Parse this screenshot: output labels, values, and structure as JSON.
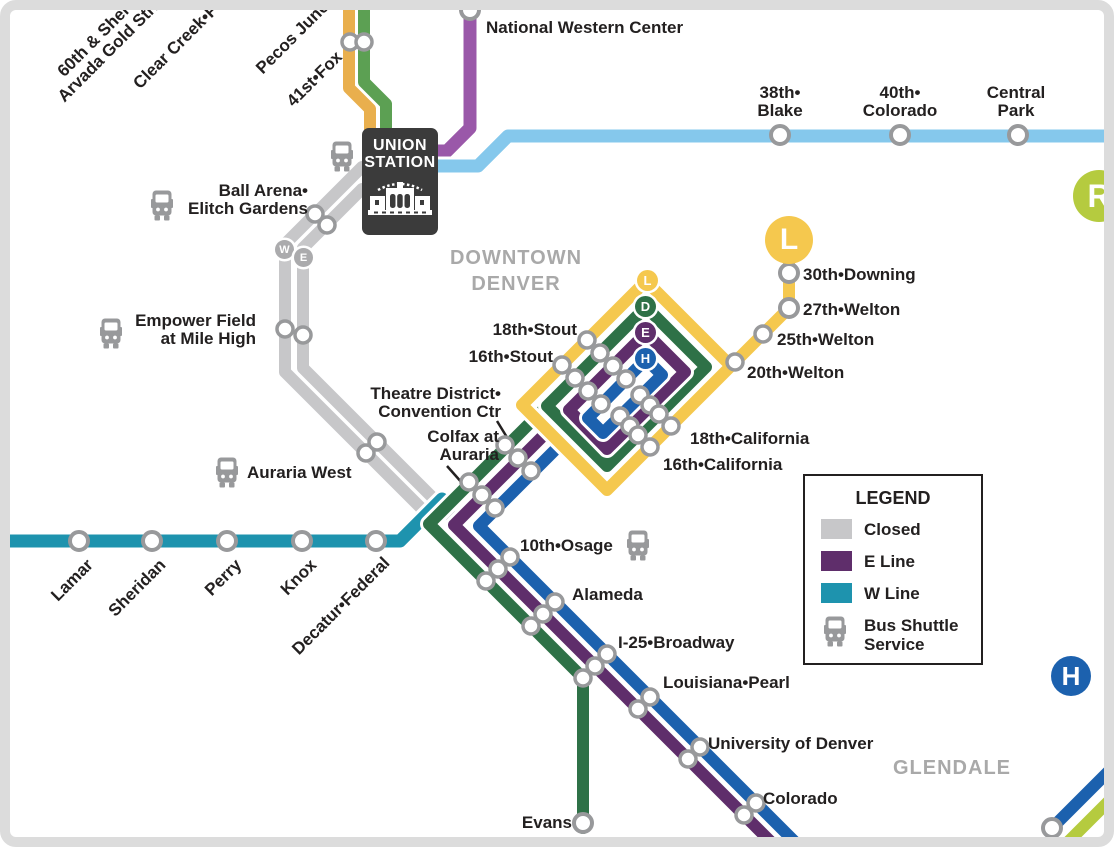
{
  "colors": {
    "l_line_yellow": "#f5c84e",
    "g_line_gold": "#e9af4d",
    "b_line_green": "#5ca053",
    "d_line_green": "#2e7147",
    "e_line_purple": "#5f2e6b",
    "n_line_purple": "#9a58a9",
    "h_line_blue": "#1c61ae",
    "a_line_blue": "#85c8ec",
    "w_line_teal": "#1e93ae",
    "r_line_lime": "#b5cb3f",
    "closed_gray": "#c7c7c9",
    "station_ring_gray": "#98999b",
    "union_station_dark": "#3b3b3b",
    "area_label_gray": "#a9a9a9"
  },
  "areas": {
    "downtown_line1": "DOWNTOWN",
    "downtown_line2": "DENVER",
    "glendale": "GLENDALE"
  },
  "union_station": {
    "name_line1": "UNION",
    "name_line2": "STATION"
  },
  "badges": {
    "l_big": "L",
    "r": "R",
    "h_big": "H",
    "loop_l": "L",
    "loop_d": "D",
    "loop_e": "E",
    "loop_h": "H",
    "closed_w": "W",
    "closed_e": "E"
  },
  "stations": {
    "g_line_top": {
      "sheridan_gold_line1": "60th & Sheridan•",
      "sheridan_gold_line2": "Arvada Gold Strike",
      "clear_creek": "Clear Creek•Federal",
      "pecos": "Pecos Junction",
      "fox": "41st•Fox"
    },
    "n_line": {
      "national_western": "National Western Center"
    },
    "a_line": {
      "blake_line1": "38th•",
      "blake_line2": "Blake",
      "colorado_line1": "40th•",
      "colorado_line2": "Colorado",
      "central_park_line1": "Central",
      "central_park_line2": "Park"
    },
    "l_line": {
      "downing": "30th•Downing",
      "welton27": "27th•Welton",
      "welton25": "25th•Welton",
      "welton20": "20th•Welton"
    },
    "loop": {
      "stout18": "18th•Stout",
      "stout16": "16th•Stout",
      "theatre_line1": "Theatre District•",
      "theatre_line2": "Convention Ctr",
      "colfax_line1": "Colfax at",
      "colfax_line2": "Auraria",
      "california18": "18th•California",
      "california16": "16th•California"
    },
    "closed_segment": {
      "ball_line1": "Ball Arena•",
      "ball_line2": "Elitch Gardens",
      "empower_line1": "Empower Field",
      "empower_line2": "at Mile High"
    },
    "w_line": {
      "lamar": "Lamar",
      "sheridan": "Sheridan",
      "perry": "Perry",
      "knox": "Knox",
      "decatur": "Decatur•Federal",
      "auraria_west": "Auraria West"
    },
    "se_corridor": {
      "osage": "10th•Osage",
      "alameda": "Alameda",
      "broadway": "I-25•Broadway",
      "louisiana": "Louisiana•Pearl",
      "university": "University of Denver",
      "colorado": "Colorado",
      "evans": "Evans"
    }
  },
  "legend": {
    "title": "LEGEND",
    "closed": "Closed",
    "e_line": "E Line",
    "w_line": "W Line",
    "bus_line1": "Bus Shuttle",
    "bus_line2": "Service"
  }
}
